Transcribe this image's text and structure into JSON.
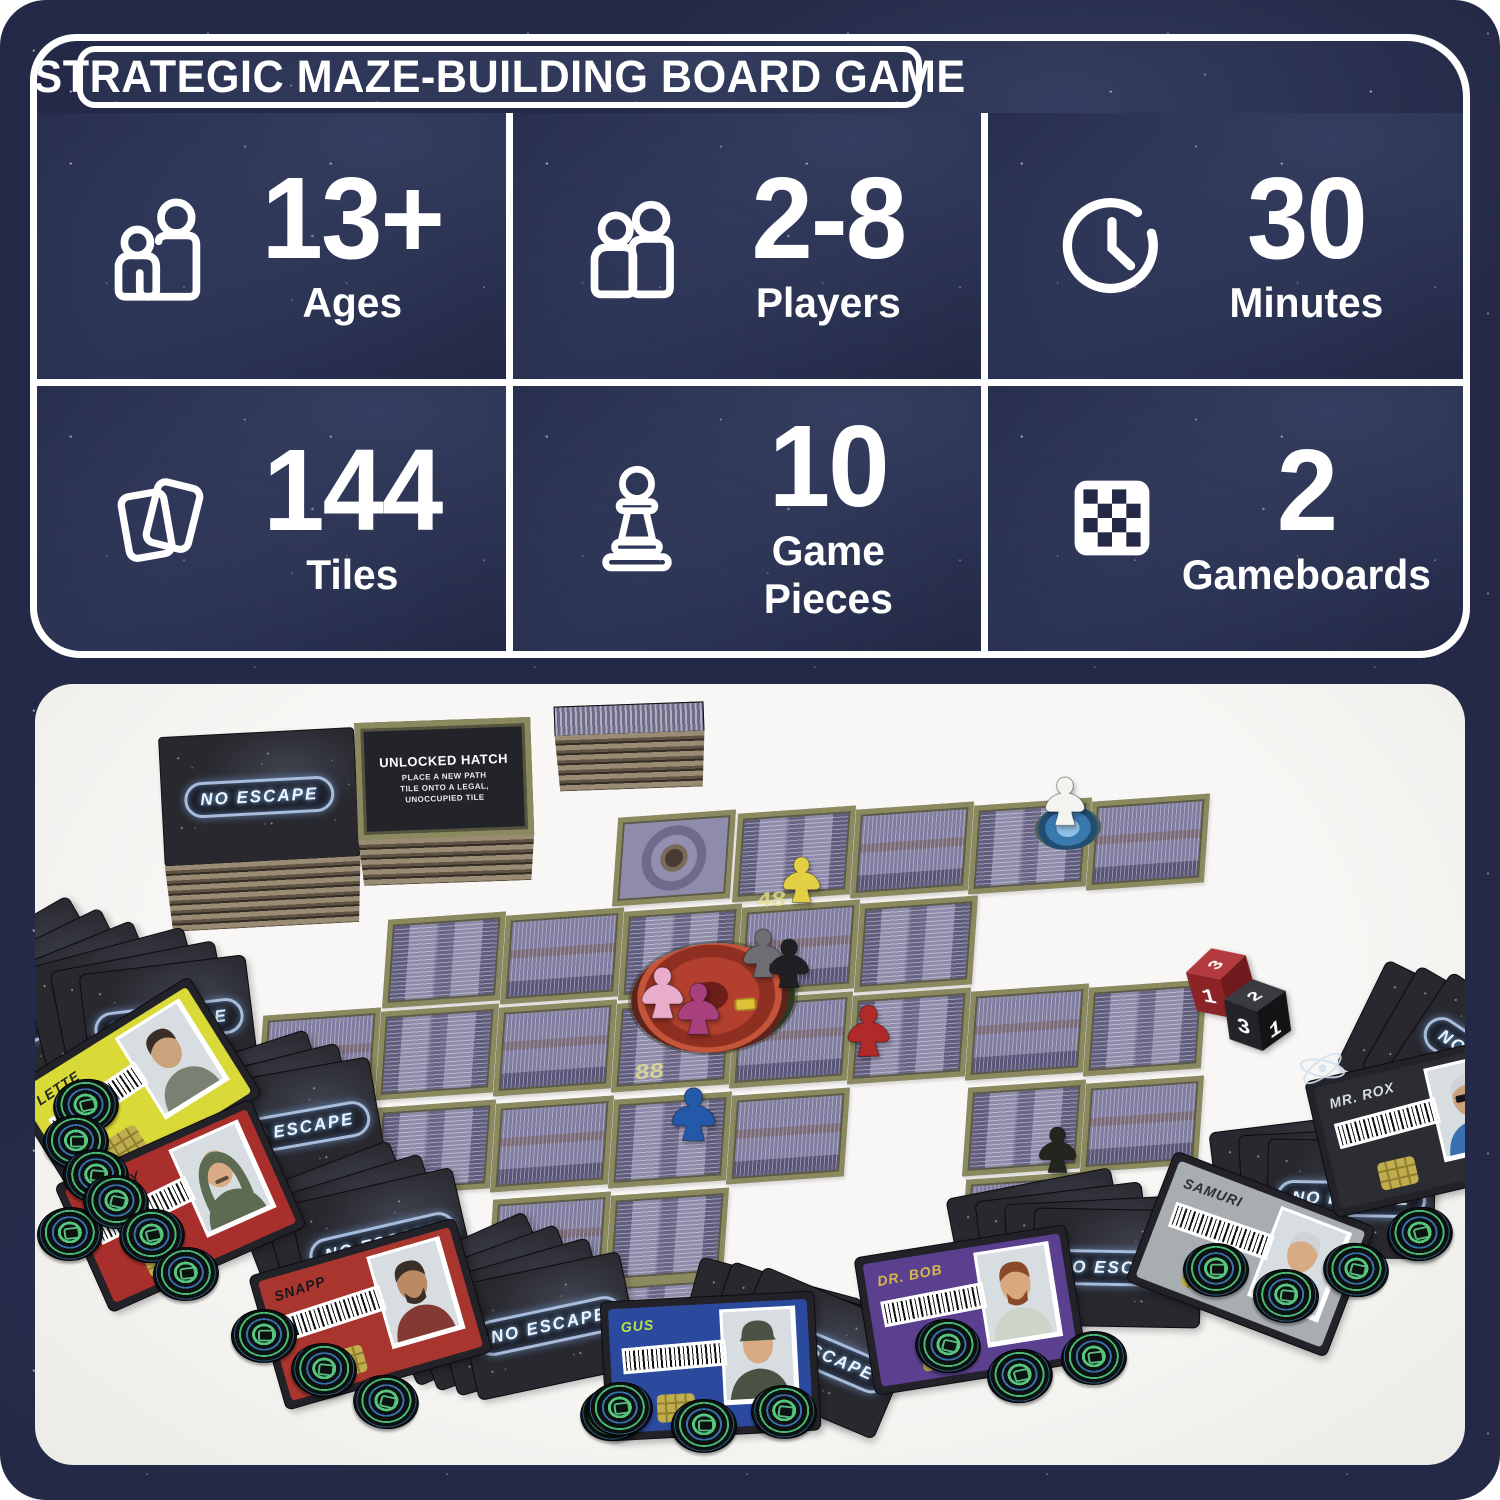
{
  "header": {
    "title": "STRATEGIC MAZE-BUILDING BOARD GAME",
    "panel_bg": "#232946",
    "line_color": "#ffffff",
    "stats": [
      {
        "icon": "ages-icon",
        "value": "13+",
        "label": "Ages"
      },
      {
        "icon": "players-icon",
        "value": "2-8",
        "label": "Players"
      },
      {
        "icon": "clock-icon",
        "value": "30",
        "label": "Minutes"
      },
      {
        "icon": "tiles-icon",
        "value": "144",
        "label": "Tiles"
      },
      {
        "icon": "pawn-icon",
        "value": "10",
        "label": "Game Pieces"
      },
      {
        "icon": "gameboard-icon",
        "value": "2",
        "label": "Gameboards"
      }
    ]
  },
  "photo": {
    "logo_text": "NO ESCAPE",
    "hatch_card": {
      "title": "UNLOCKED HATCH",
      "lines": [
        "PLACE A NEW PATH",
        "TILE ONTO A LEGAL,",
        "UNOCCUPIED TILE"
      ]
    },
    "board_markings": [
      {
        "text": "48",
        "x": 722,
        "y": 200
      },
      {
        "text": "88",
        "x": 600,
        "y": 372
      }
    ],
    "tiles": [
      [
        580,
        130,
        "oct"
      ],
      [
        700,
        126,
        "p"
      ],
      [
        818,
        122,
        "v2"
      ],
      [
        936,
        118,
        "p"
      ],
      [
        1054,
        114,
        "v2"
      ],
      [
        350,
        232,
        "p"
      ],
      [
        468,
        228,
        "v2"
      ],
      [
        586,
        224,
        "p"
      ],
      [
        704,
        220,
        "v2"
      ],
      [
        822,
        216,
        "p"
      ],
      [
        225,
        328,
        "v2"
      ],
      [
        343,
        324,
        "p"
      ],
      [
        461,
        320,
        "v2"
      ],
      [
        579,
        316,
        "p"
      ],
      [
        697,
        312,
        "v2"
      ],
      [
        815,
        308,
        "p"
      ],
      [
        933,
        304,
        "v2"
      ],
      [
        1051,
        300,
        "p"
      ],
      [
        340,
        420,
        "p"
      ],
      [
        458,
        416,
        "v2"
      ],
      [
        576,
        412,
        "p"
      ],
      [
        694,
        408,
        "v2"
      ],
      [
        930,
        400,
        "p"
      ],
      [
        1048,
        396,
        "v2"
      ],
      [
        455,
        512,
        "v2"
      ],
      [
        573,
        508,
        "p"
      ],
      [
        928,
        492,
        "v2"
      ],
      [
        560,
        596,
        "p"
      ]
    ],
    "hub": {
      "x": 596,
      "y": 244
    },
    "pod": {
      "x": 1000,
      "y": 116
    },
    "stacks": [
      {
        "name": "tile-stack-logo",
        "x": 128,
        "y": 48,
        "w": 196,
        "h": 130,
        "side": 66,
        "rot": -3,
        "face": "logo"
      },
      {
        "name": "tile-stack-hatch",
        "x": 322,
        "y": 36,
        "w": 176,
        "h": 118,
        "side": 46,
        "rot": -2,
        "face": "hatch"
      },
      {
        "name": "tile-stack-side",
        "x": 520,
        "y": 20,
        "w": 150,
        "h": 30,
        "side": 56,
        "rot": -2,
        "face": "tiles"
      }
    ],
    "meeples": [
      {
        "name": "yellow-meeple",
        "color": "#e3cf43",
        "x": 742,
        "y": 166,
        "s": 0.95
      },
      {
        "name": "white-meeple",
        "color": "#f3f3f0",
        "x": 1004,
        "y": 86,
        "s": 1.0
      },
      {
        "name": "pink-meeple",
        "color": "#eaaccb",
        "x": 600,
        "y": 276,
        "s": 1.05
      },
      {
        "name": "magenta-meeple",
        "color": "#a8407e",
        "x": 636,
        "y": 292,
        "s": 1.05
      },
      {
        "name": "gray-meeple",
        "color": "#6e6e74",
        "x": 702,
        "y": 238,
        "s": 1.0
      },
      {
        "name": "black-meeple",
        "color": "#1f1f24",
        "x": 728,
        "y": 248,
        "s": 1.0
      },
      {
        "name": "red-meeple",
        "color": "#b02a2a",
        "x": 806,
        "y": 314,
        "s": 1.05
      },
      {
        "name": "blue-meeple",
        "color": "#2458a8",
        "x": 630,
        "y": 396,
        "s": 1.1
      },
      {
        "name": "dark-meeple",
        "color": "#23251f",
        "x": 998,
        "y": 436,
        "s": 0.95
      }
    ],
    "dice": [
      {
        "name": "red-die",
        "top": "#b33a3e",
        "left": "#8c2327",
        "right": "#701a1e",
        "digits": {
          "top": "3",
          "left": "1",
          "right": ""
        },
        "x": 1150,
        "y": 258,
        "rot": -16
      },
      {
        "name": "black-die",
        "top": "#3a3a40",
        "left": "#242428",
        "right": "#141417",
        "digits": {
          "top": "2",
          "left": "3",
          "right": "1"
        },
        "x": 1186,
        "y": 290,
        "rot": -8
      }
    ],
    "card_fans": [
      {
        "n": 3,
        "x": -95,
        "y": 245,
        "rot": -30
      },
      {
        "n": 3,
        "x": -2,
        "y": 262,
        "rot": -15
      },
      {
        "n": 3,
        "x": 125,
        "y": 368,
        "rot": -18
      },
      {
        "n": 3,
        "x": 212,
        "y": 482,
        "rot": -21
      },
      {
        "n": 4,
        "x": 352,
        "y": 556,
        "rot": -24
      },
      {
        "n": 3,
        "x": 648,
        "y": 592,
        "rot": 15
      },
      {
        "n": 4,
        "x": 920,
        "y": 498,
        "rot": -11
      },
      {
        "n": 3,
        "x": 1180,
        "y": 438,
        "rot": -7
      },
      {
        "n": 3,
        "x": 1318,
        "y": 306,
        "rot": 26
      }
    ],
    "character_cards": [
      {
        "name": "LETTE",
        "x": -8,
        "y": 338,
        "rot": -32,
        "accent": "#d9d938",
        "name_color": "#23281e",
        "skin": "#caa27b",
        "hair": "dark",
        "torso": "#7a8072",
        "extras": []
      },
      {
        "name": "FROSTY",
        "x": 38,
        "y": 452,
        "rot": -24,
        "accent": "#a82f2c",
        "name_color": "#1d1d1d",
        "skin": "#d8ab84",
        "hair": "hood",
        "torso": "#5c6b52",
        "extras": [
          "mustache"
        ]
      },
      {
        "name": "SNAPP",
        "x": 228,
        "y": 560,
        "rot": -16,
        "accent": "#a8352e",
        "name_color": "#17171b",
        "skin": "#b98a63",
        "hair": "dark",
        "torso": "#833a33",
        "extras": [
          "beard"
        ]
      },
      {
        "name": "GUS",
        "x": 568,
        "y": 612,
        "rot": -3,
        "accent": "#2b4a9e",
        "name_color": "#b8e04a",
        "skin": "#d8ab84",
        "hair": "cap",
        "torso": "#4a5244",
        "extras": []
      },
      {
        "name": "DR. BOB",
        "x": 828,
        "y": 556,
        "rot": -9,
        "accent": "#5c4090",
        "name_color": "#d8b84a",
        "skin": "#d8a87e",
        "hair": "auburn",
        "torso": "#cfd4c8",
        "extras": [
          "beard"
        ]
      },
      {
        "name": "SAMURI",
        "x": 1108,
        "y": 500,
        "rot": 21,
        "accent": "#a7adb0",
        "name_color": "#2a2f33",
        "skin": "#d8ab84",
        "hair": "silver",
        "torso": "#9aa29e",
        "extras": []
      },
      {
        "name": "MR. ROX",
        "x": 1282,
        "y": 372,
        "rot": -13,
        "accent": "#2c2d33",
        "name_color": "#d8dde2",
        "skin": "#caa27b",
        "hair": "silver",
        "torso": "#3a6fb0",
        "extras": [
          "sunglasses",
          "atom"
        ]
      }
    ],
    "tokens": [
      {
        "x": 18,
        "y": 392
      },
      {
        "x": 2,
        "y": 520
      },
      {
        "x": 8,
        "y": 428
      },
      {
        "x": 28,
        "y": 462
      },
      {
        "x": 48,
        "y": 488
      },
      {
        "x": 84,
        "y": 522
      },
      {
        "x": 118,
        "y": 560
      },
      {
        "x": 196,
        "y": 622
      },
      {
        "x": 256,
        "y": 656
      },
      {
        "x": 318,
        "y": 688
      },
      {
        "x": 545,
        "y": 700
      },
      {
        "x": 552,
        "y": 695
      },
      {
        "x": 636,
        "y": 712
      },
      {
        "x": 716,
        "y": 698
      },
      {
        "x": 880,
        "y": 632
      },
      {
        "x": 952,
        "y": 662
      },
      {
        "x": 1026,
        "y": 644
      },
      {
        "x": 1148,
        "y": 556
      },
      {
        "x": 1218,
        "y": 582
      },
      {
        "x": 1288,
        "y": 556
      },
      {
        "x": 1352,
        "y": 520
      }
    ]
  }
}
